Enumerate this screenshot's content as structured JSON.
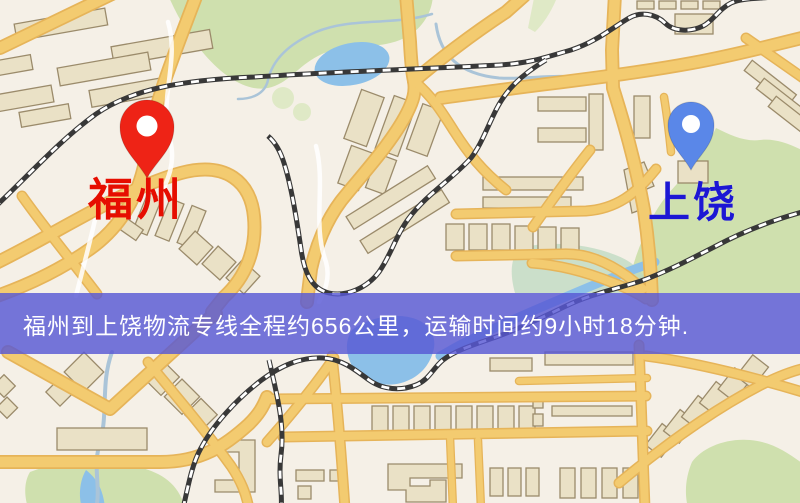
{
  "banner": {
    "text": "福州到上饶物流专线全程约656公里，运输时间约9小时18分钟.",
    "bg_color": "rgba(88,88,212,0.82)",
    "text_color": "#ffffff"
  },
  "route": {
    "origin": "福州",
    "destination": "上饶",
    "distance": "约656公里",
    "duration": "约9小时18分钟"
  },
  "markers": {
    "origin": {
      "label": "福州",
      "label_color": "#e60d00",
      "pin_color": "#ee2316"
    },
    "destination": {
      "label": "上饶",
      "label_color": "#1c17d4",
      "pin_color": "#5a87e8"
    }
  },
  "map_palette": {
    "background": "#f5f0e7",
    "road_fill": "#f3cb70",
    "road_casing": "#e6b459",
    "minor_road": "#ffffff",
    "park": "#cfe0ae",
    "park_light": "#dfe9c6",
    "marsh": "#bcd9c0",
    "water": "#8cc0e8",
    "stream": "#aac4d8",
    "building_fill": "#eae1c6",
    "building_stroke": "#9b8b6b",
    "railway": "#383838",
    "railway_dash": "#ffffff"
  }
}
